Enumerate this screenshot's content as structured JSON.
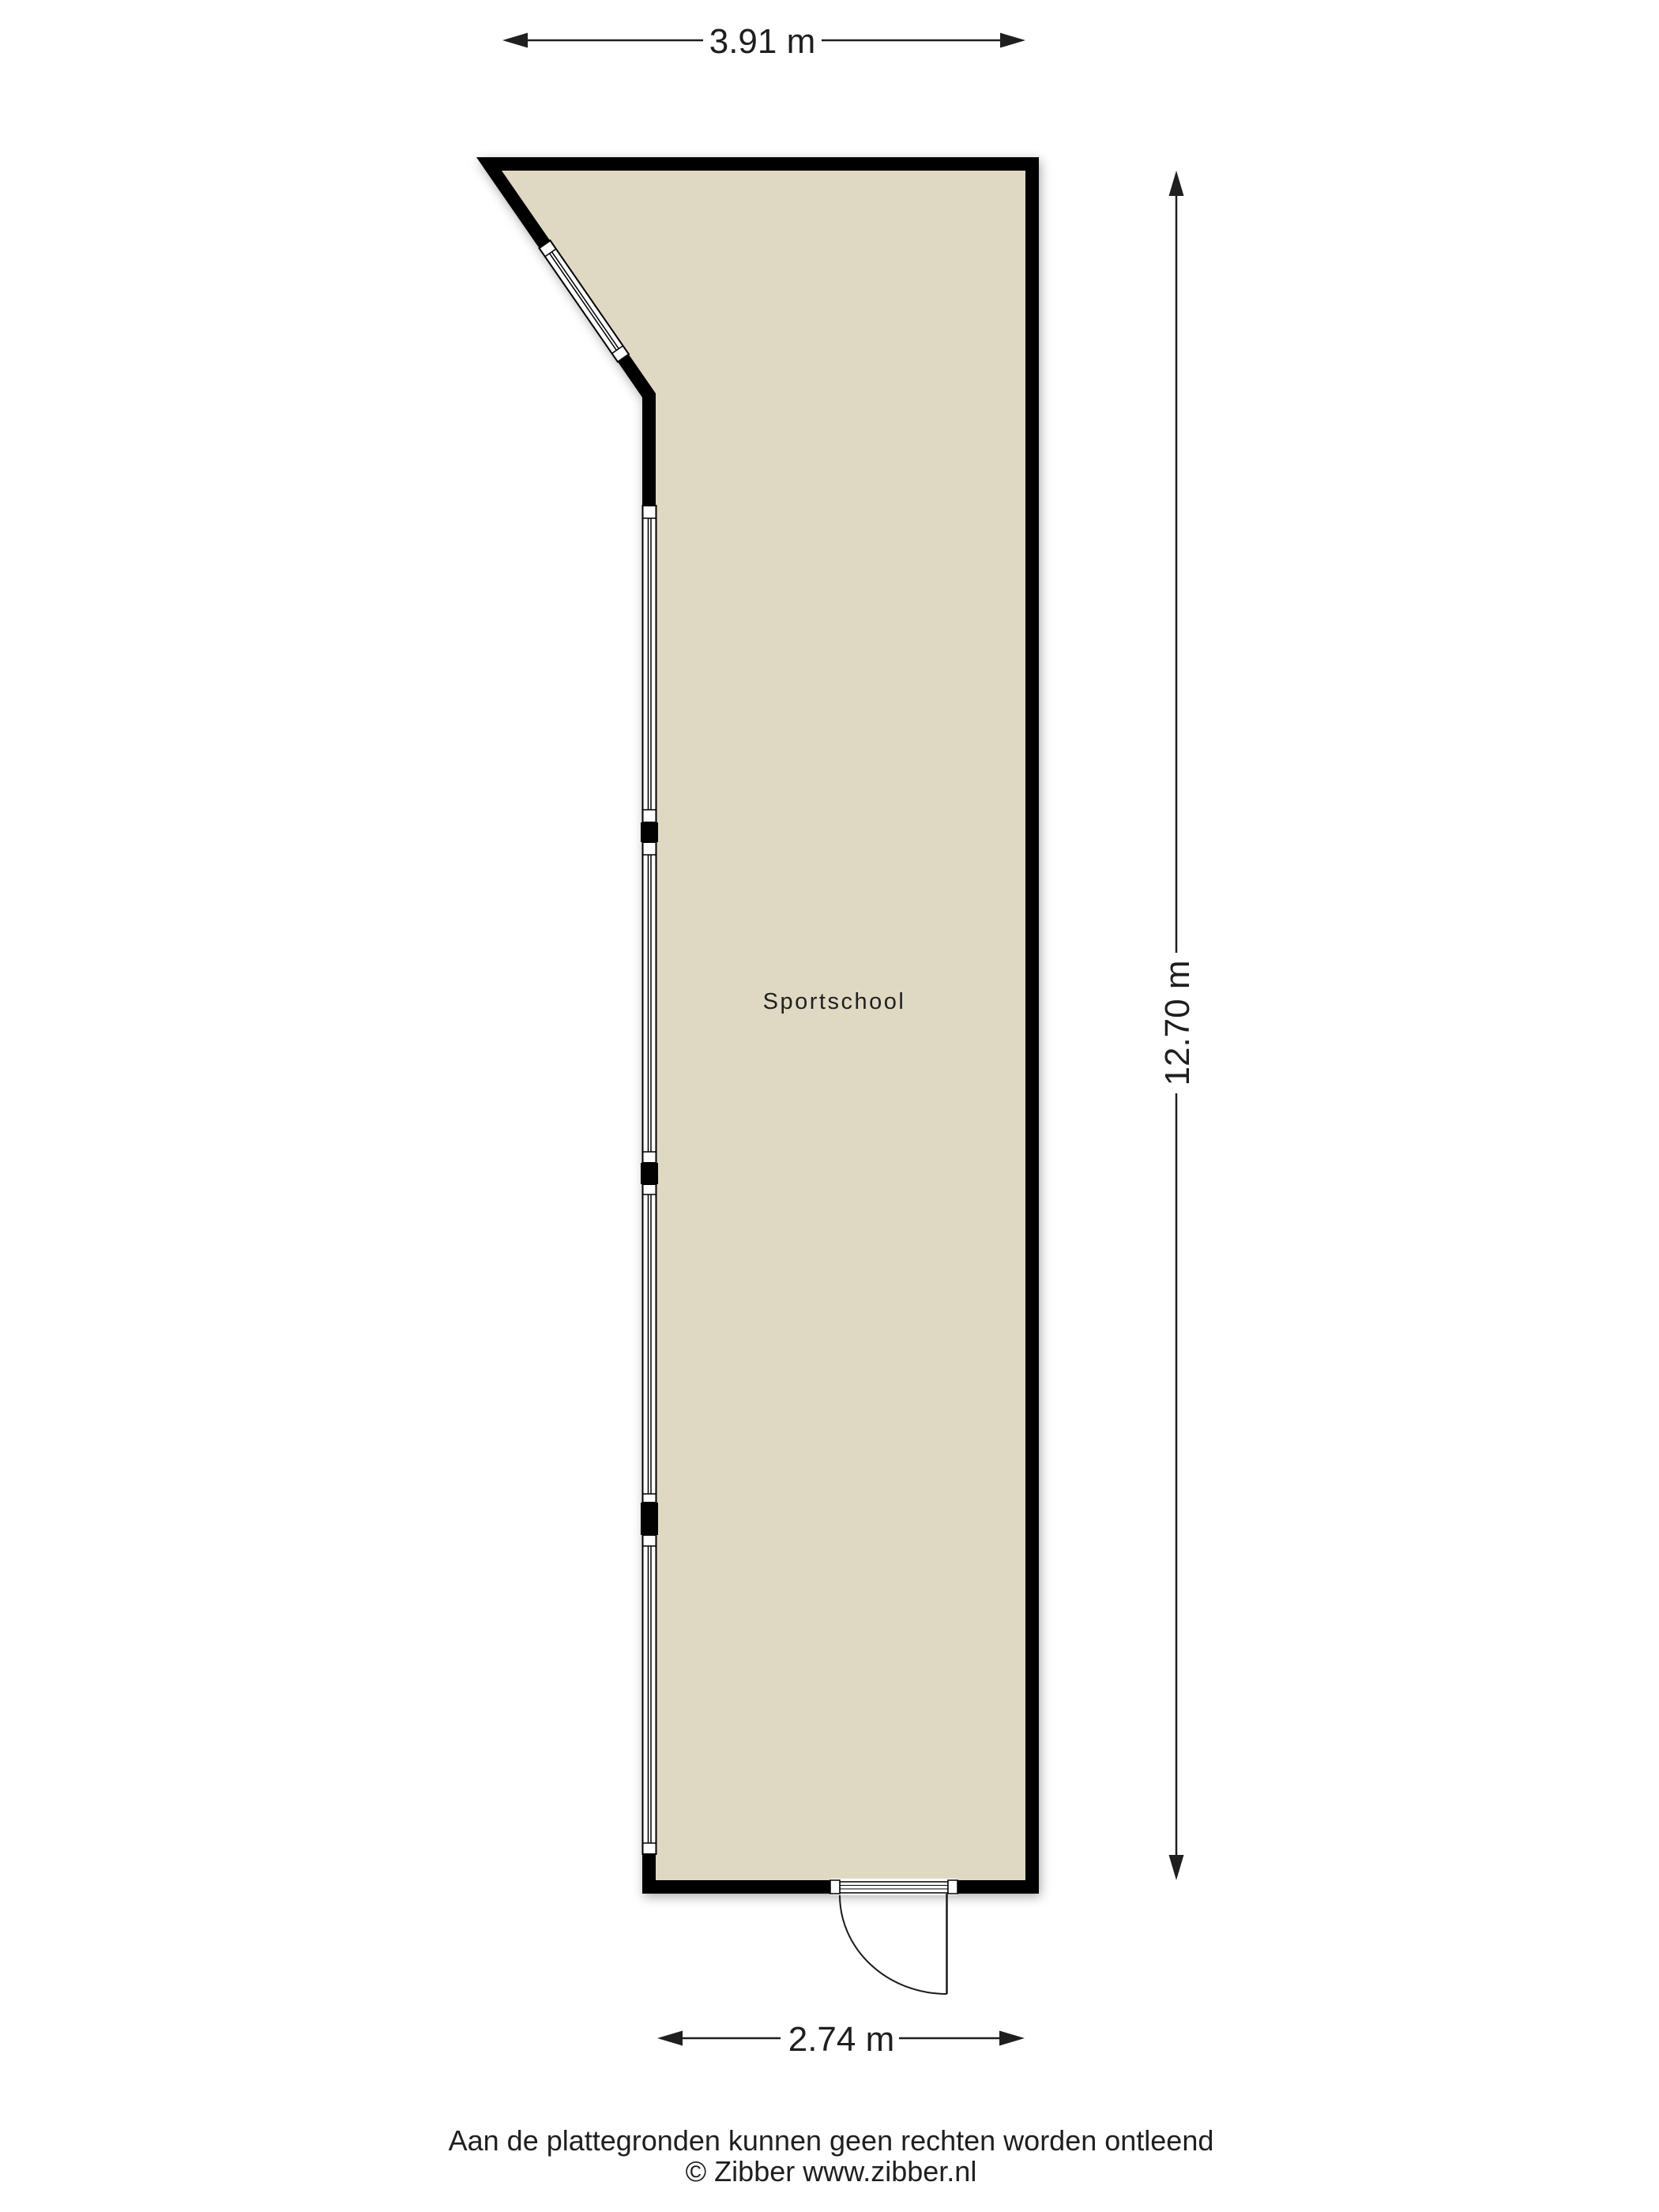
{
  "floorplan": {
    "room_label": "Sportschool",
    "dimensions": {
      "top_label": "3.91 m",
      "right_label": "12.70 m",
      "bottom_label": "2.74 m"
    },
    "footer": {
      "disclaimer": "Aan de plattegronden kunnen geen rechten worden ontleend",
      "copyright": "© Zibber www.zibber.nl"
    },
    "colors": {
      "floor": "#dfd9c4",
      "wall": "#020202",
      "dimension": "#1f1f1f",
      "window": "#ffffff"
    }
  }
}
